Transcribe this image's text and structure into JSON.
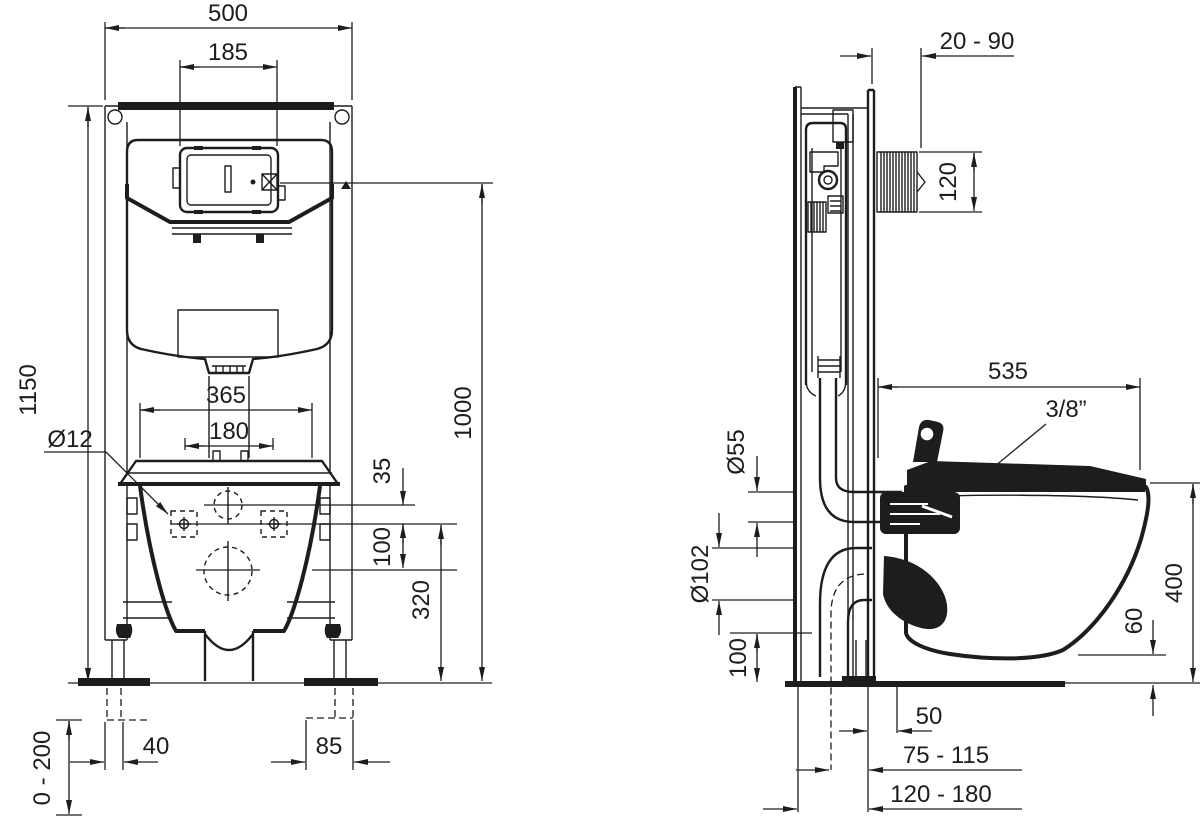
{
  "drawing": {
    "background": "#ffffff",
    "line_color": "#1d1d1b",
    "type": "installation-dimension-drawing",
    "front_view": {
      "frame_width": "500",
      "flush_plate_width": "185",
      "frame_height": "1150",
      "bowl_width": "365",
      "bolt_spacing": "180",
      "bolt_diameter": "Ø12",
      "flush_to_bolts": "35",
      "bolts_to_outlet": "100",
      "outlet_height": "320",
      "flush_plate_height": "1000",
      "foot_offset_left": "40",
      "foot_offset_right": "85",
      "foot_adjustment": "0 - 200"
    },
    "side_view": {
      "wall_distance": "20 - 90",
      "flush_plate_recess": "120",
      "bowl_projection": "535",
      "water_connection": "3/8”",
      "flush_pipe_diameter": "Ø55",
      "outlet_diameter": "Ø102",
      "outlet_bottom_height": "100",
      "outlet_offset": "50",
      "outlet_to_wall_range": "75 - 115",
      "frame_depth_range": "120 - 180",
      "bowl_underside_height": "60",
      "rim_height": "400"
    }
  }
}
